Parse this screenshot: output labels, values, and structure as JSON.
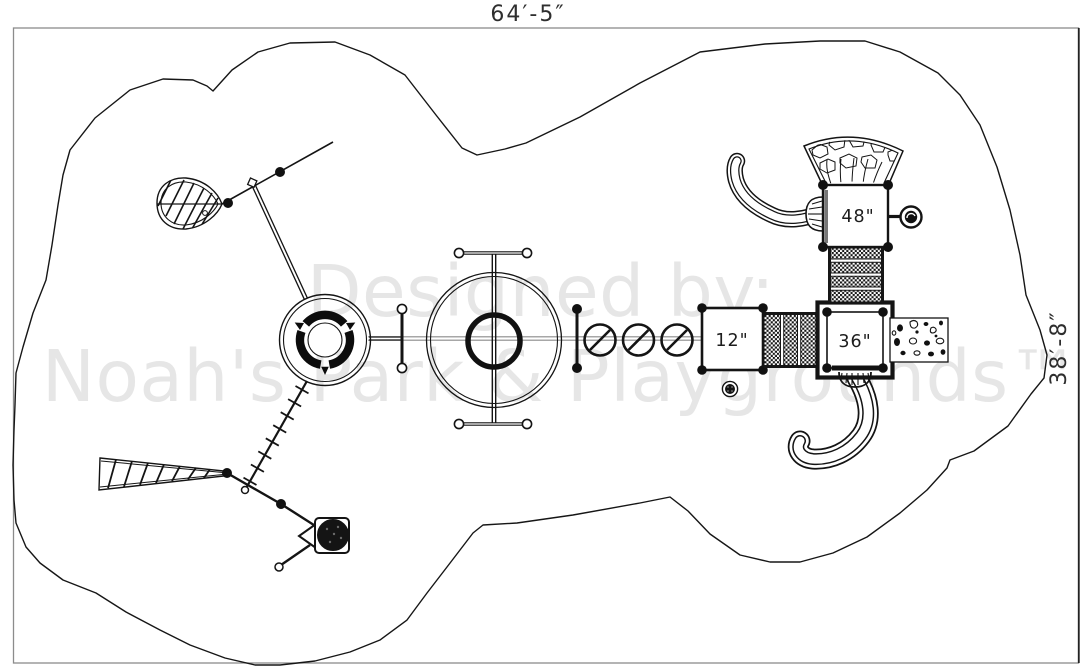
{
  "drawing": {
    "dimension_top": "64′-5″",
    "dimension_right": "38′-8″",
    "watermark_line1": "Designed by:",
    "watermark_line2": "Noah's Park & Playgrounds™",
    "deck_labels": {
      "deck_48": "48\"",
      "deck_36": "36\"",
      "deck_12": "12\""
    },
    "colors": {
      "line": "#141414",
      "frame_gray": "#8c8c8c",
      "rail_gray": "#8a8a8a",
      "watermark": "#e6e6e6",
      "dimension_text": "#2e2e2e"
    }
  }
}
